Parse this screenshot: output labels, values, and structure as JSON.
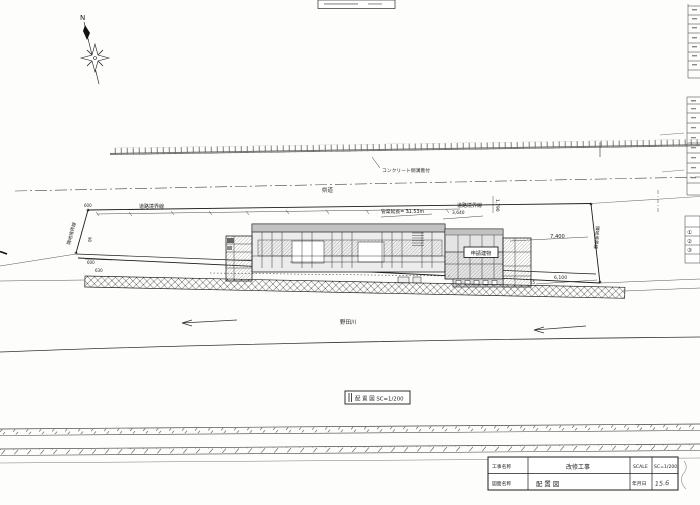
{
  "meta": {
    "paper": "#fdfdfc",
    "ink": "#1c1c1c"
  },
  "compass": {
    "north": "N"
  },
  "labels": {
    "road_name": "県道",
    "gutter": "コンクリート側溝蓋付",
    "pipe_length": "管渠延長= 31.53m",
    "road_boundary": "道路境界線",
    "adjacent_boundary": "隣地境界線",
    "building": "申請建物",
    "river": "野田川",
    "caption": "配 置 図  SC=1/200"
  },
  "dims": {
    "w7400": "7,400",
    "w6100": "6,100",
    "h1790": "1,790",
    "w3640": "3,640",
    "d600": "600",
    "d630": "630",
    "d90": "90",
    "d15": "15"
  },
  "legend": {
    "i1": "①",
    "i2": "②",
    "i3": "③"
  },
  "title_block": {
    "project_label": "工事名称",
    "project_value": "改修工事",
    "scale_label": "SCALE",
    "scale_value": "SC=1/200",
    "sheet_label": "図面名称",
    "sheet_value": "配 置 図",
    "date_label": "年月日",
    "date_value": "15.6"
  }
}
